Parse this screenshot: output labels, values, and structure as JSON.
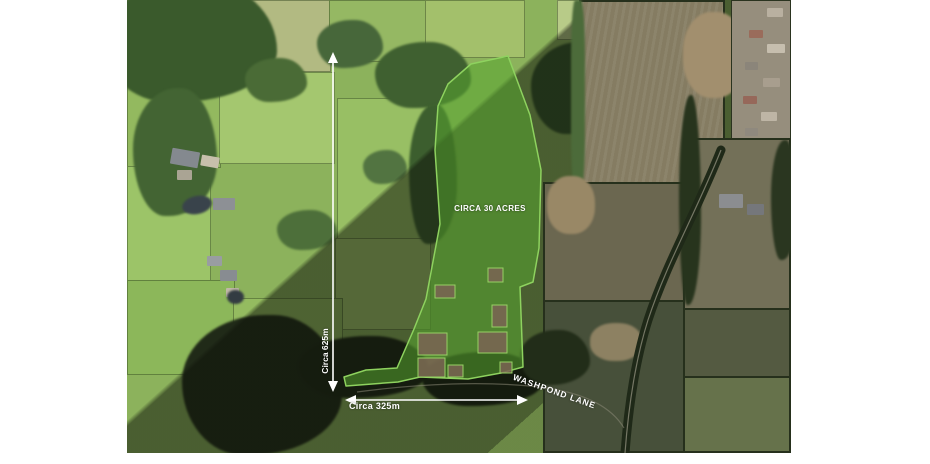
{
  "map": {
    "description": "Aerial photograph of countryside land parcel for sale",
    "parcel": {
      "area_label": "CIRCA 30 ACRES",
      "fill_color": "#58a630",
      "outline_color": "#8ed25f"
    },
    "measurements": {
      "vertical_label": "Circa 625m",
      "horizontal_label": "Circa 325m"
    },
    "road_label": "WASHPOND LANE",
    "annotation_color": "#ffffff"
  }
}
